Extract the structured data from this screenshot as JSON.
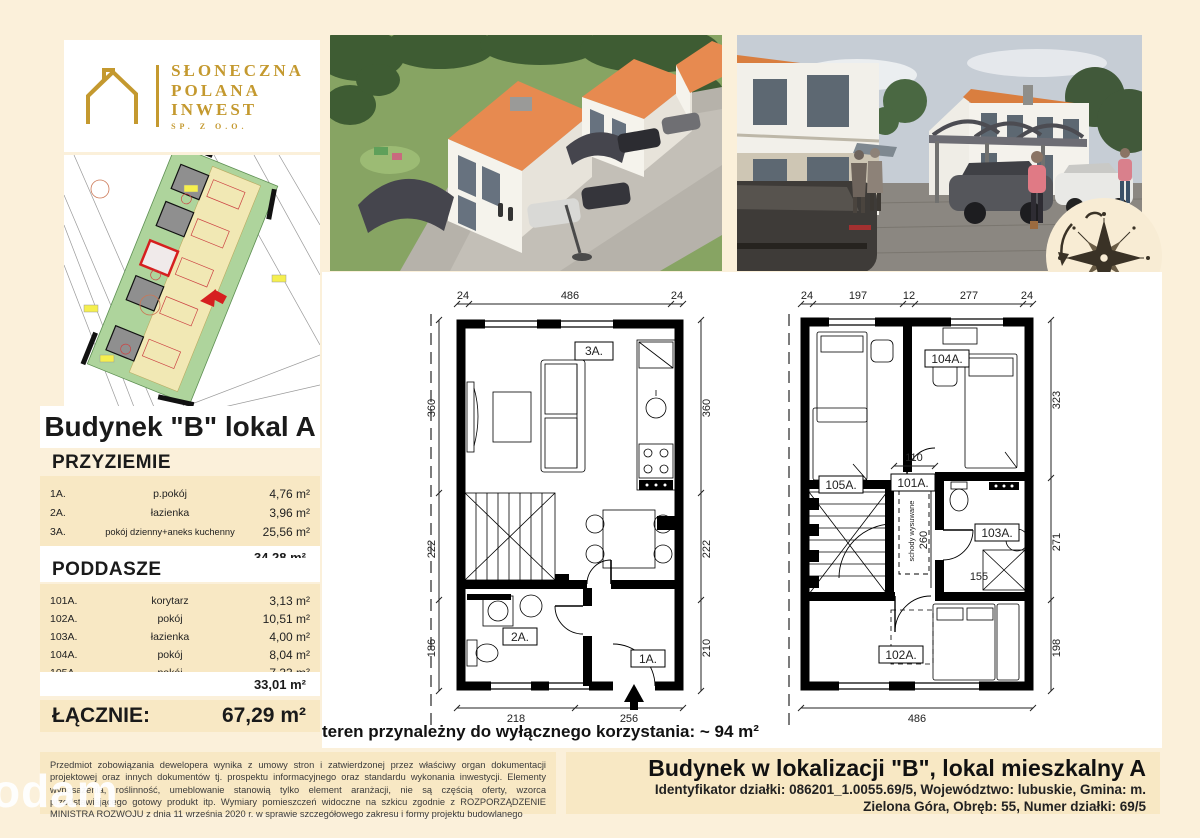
{
  "brand": {
    "line1": "SŁONECZNA",
    "line2": "POLANA",
    "line3": "INWEST",
    "sub": "SP. Z O.O.",
    "gold": "#C4992F"
  },
  "sidebar": {
    "building_title": "Budynek \"B\" lokal A",
    "sections": [
      {
        "title": "PRZYZIEMIE",
        "rows": [
          {
            "no": "1A.",
            "name": "p.pokój",
            "area": "4,76 m²"
          },
          {
            "no": "2A.",
            "name": "łazienka",
            "area": "3,96 m²"
          },
          {
            "no": "3A.",
            "name": "pokój dzienny+aneks kuchenny",
            "area": "25,56 m²"
          }
        ],
        "total": "34,28 m²"
      },
      {
        "title": "PODDASZE",
        "rows": [
          {
            "no": "101A.",
            "name": "korytarz",
            "area": "3,13 m²"
          },
          {
            "no": "102A.",
            "name": "pokój",
            "area": "10,51 m²"
          },
          {
            "no": "103A.",
            "name": "łazienka",
            "area": "4,00 m²"
          },
          {
            "no": "104A.",
            "name": "pokój",
            "area": "8,04 m²"
          },
          {
            "no": "105A.",
            "name": "pokój",
            "area": "7,33 m²"
          }
        ],
        "total": "33,01 m²"
      }
    ],
    "grand_total_label": "ŁĄCZNIE:",
    "grand_total_value": "67,29 m²"
  },
  "plans": {
    "ground": {
      "rooms": {
        "living": "3A.",
        "bath": "2A.",
        "hall": "1A."
      },
      "dims_top": [
        "24",
        "486",
        "24"
      ],
      "dims_left": [
        "360",
        "222",
        "186"
      ],
      "dims_right": [
        "360",
        "222",
        "210"
      ],
      "dims_bottom": [
        "218",
        "256"
      ]
    },
    "attic": {
      "rooms": {
        "corridor": "101A.",
        "room102": "102A.",
        "bath": "103A.",
        "room104": "104A.",
        "room105": "105A."
      },
      "dims_top": [
        "24",
        "197",
        "12",
        "277",
        "24"
      ],
      "dims_right": [
        "323",
        "271",
        "198"
      ],
      "dims_bottom": [
        "486"
      ],
      "dim_corridor_width": "110",
      "dim_corridor_length": "260",
      "dim_shower": "155",
      "stairs_note": "schody wysuwane"
    }
  },
  "land_note": "teren przynależny do wyłącznego korzystania: ~ 94 m²",
  "footer": {
    "disclaimer": "Przedmiot zobowiązania dewelopera wynika z umowy stron i zatwierdzonej przez właściwy organ dokumentacji projektowej oraz innych dokumentów tj. prospektu informacyjnego oraz standardu wykonania inwestycji. Elementy wyposażenia, roślinność, umeblowanie stanowią tylko element aranżacji, nie są częścią oferty, wzorca przedstawiającego gotowy produkt itp. Wymiary pomieszczeń widoczne na szkicu zgodnie z ROZPORZĄDZENIE MINISTRA ROZWOJU z dnia 11 września 2020 r. w sprawie szczegółowego zakresu i formy projektu budowlanego",
    "title": "Budynek w lokalizacji \"B\", lokal mieszkalny A",
    "id_line1": "Identyfikator działki: 086201_1.0055.69/5, Województwo: lubuskie, Gmina: m.",
    "id_line2": "Zielona Góra, Obręb: 55, Numer działki: 69/5"
  },
  "watermark": "odam"
}
